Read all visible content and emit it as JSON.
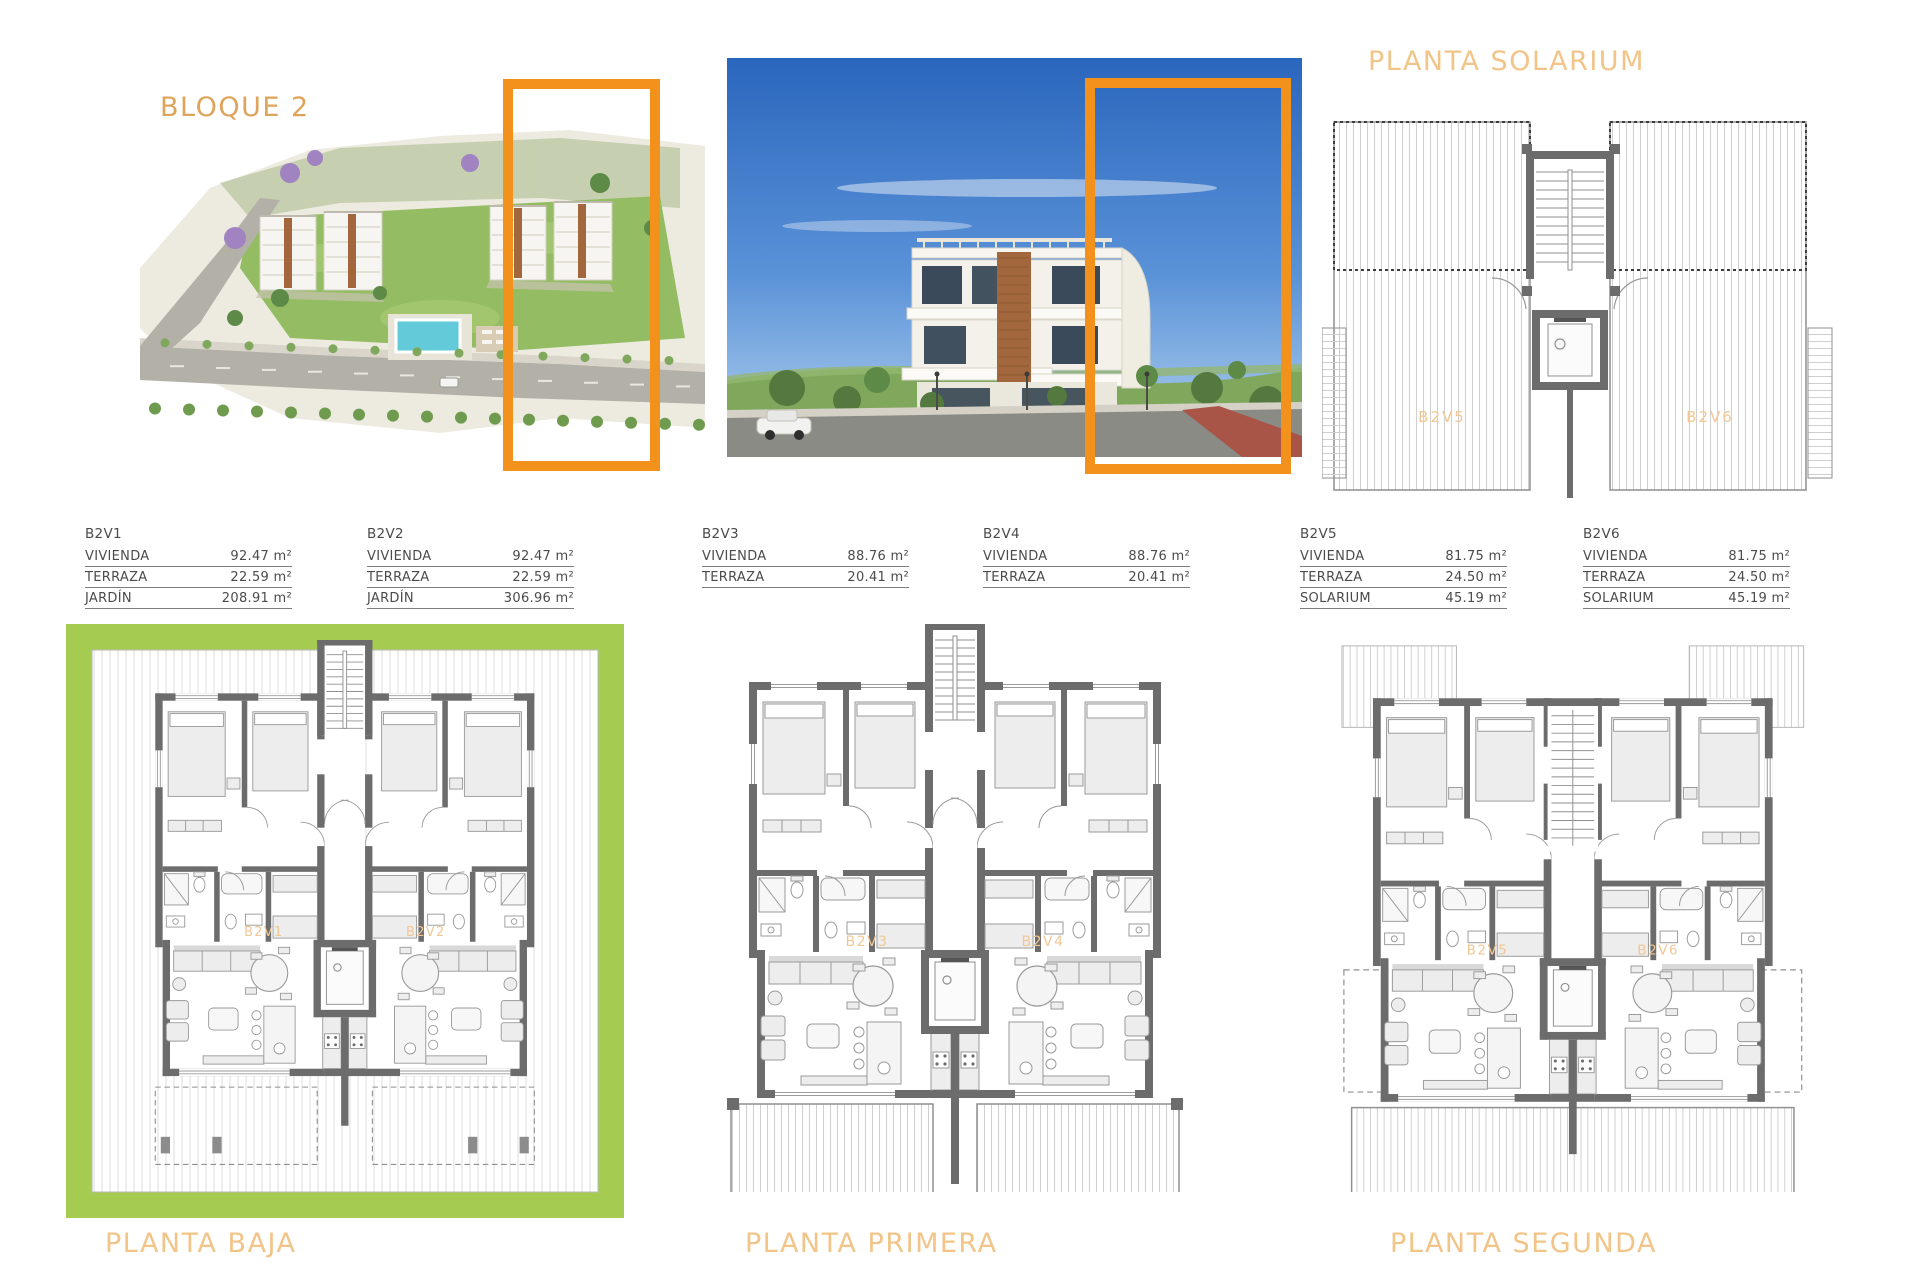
{
  "header": {
    "block_title": "BLOQUE 2",
    "solarium_title": "PLANTA SOLARIUM"
  },
  "images": {
    "aerial_render_alt": "aerial site render of Bloque 2 with highlighted building",
    "street_render_alt": "street level render of highlighted building"
  },
  "colors": {
    "accent_orange": "#F2921D",
    "title_tan": "#DFA45C",
    "title_light_tan": "#F2C488",
    "plan_label_orange": "#F0C795",
    "wall_gray": "#6c6c6c",
    "thin_gray": "#9a9a9a",
    "hatch_gray": "#cfcfcf",
    "garden_green": "#A5CB50",
    "table_text": "#4b4b4b",
    "sky_top": "#2a66bd",
    "sky_bottom": "#b7d4ef",
    "pool_cyan": "#62cad8"
  },
  "unit_tables": [
    {
      "unit": "B2V1",
      "rows": [
        {
          "label": "VIVIENDA",
          "value": "92.47 m²"
        },
        {
          "label": "TERRAZA",
          "value": "22.59 m²"
        },
        {
          "label": "JARDÍN",
          "value": "208.91 m²"
        }
      ]
    },
    {
      "unit": "B2V2",
      "rows": [
        {
          "label": "VIVIENDA",
          "value": "92.47 m²"
        },
        {
          "label": "TERRAZA",
          "value": "22.59 m²"
        },
        {
          "label": "JARDÍN",
          "value": "306.96 m²"
        }
      ]
    },
    {
      "unit": "B2V3",
      "rows": [
        {
          "label": "VIVIENDA",
          "value": "88.76 m²"
        },
        {
          "label": "TERRAZA",
          "value": "20.41 m²"
        }
      ]
    },
    {
      "unit": "B2V4",
      "rows": [
        {
          "label": "VIVIENDA",
          "value": "88.76 m²"
        },
        {
          "label": "TERRAZA",
          "value": "20.41 m²"
        }
      ]
    },
    {
      "unit": "B2V5",
      "rows": [
        {
          "label": "VIVIENDA",
          "value": "81.75 m²"
        },
        {
          "label": "TERRAZA",
          "value": "24.50 m²"
        },
        {
          "label": "SOLARIUM",
          "value": "45.19 m²"
        }
      ]
    },
    {
      "unit": "B2V6",
      "rows": [
        {
          "label": "VIVIENDA",
          "value": "81.75 m²"
        },
        {
          "label": "TERRAZA",
          "value": "24.50 m²"
        },
        {
          "label": "SOLARIUM",
          "value": "45.19 m²"
        }
      ]
    }
  ],
  "floor_plans": [
    {
      "title": "PLANTA BAJA",
      "units": [
        "B2V1",
        "B2V2"
      ],
      "variant": "baja"
    },
    {
      "title": "PLANTA PRIMERA",
      "units": [
        "B2V3",
        "B2V4"
      ],
      "variant": "primera"
    },
    {
      "title": "PLANTA SEGUNDA",
      "units": [
        "B2V5",
        "B2V6"
      ],
      "variant": "segunda"
    }
  ],
  "solarium_plan": {
    "units": [
      "B2V5",
      "B2V6"
    ]
  }
}
